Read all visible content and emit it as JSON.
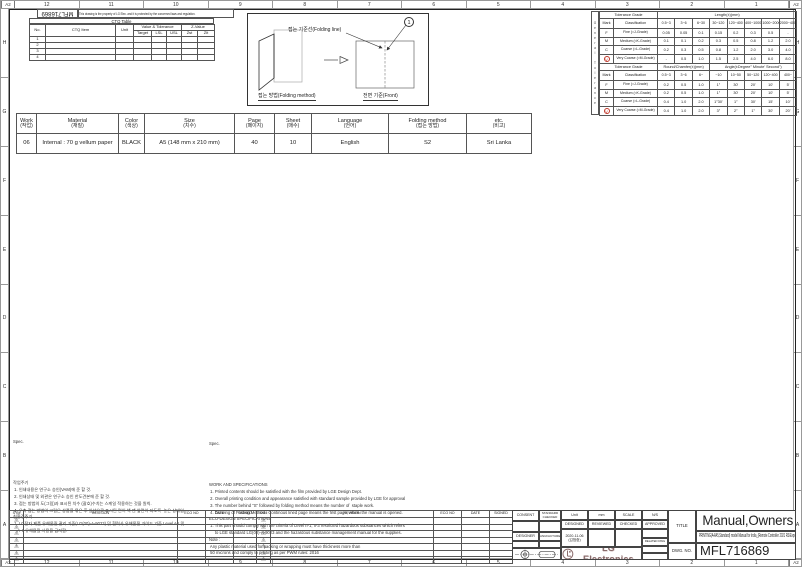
{
  "sheet": {
    "corner": "A2",
    "cols": [
      "12",
      "11",
      "10",
      "9",
      "8",
      "7",
      "6",
      "5",
      "4",
      "3",
      "2",
      "1"
    ],
    "rows": [
      "H",
      "G",
      "F",
      "E",
      "D",
      "C",
      "B",
      "A"
    ]
  },
  "top_left": {
    "doc_no": "MFL716869",
    "disclaimer": "This drawing is the property of LG Elec. and it is protected by the concerned laws and regulation."
  },
  "ctq": {
    "title": "CTQ Table",
    "no": "No.",
    "item": "CTQ Item",
    "unit": "Unit",
    "value_grp": "Value & Tolerance",
    "z_grp": "Z-Value",
    "target": "Target",
    "lsl": "LSL",
    "usl": "USL",
    "zst": "Zst",
    "zlt": "Zlt",
    "rows": [
      "1",
      "2",
      "3",
      "4"
    ]
  },
  "folding": {
    "line_label": "접는 기준선(Folding line)",
    "method_label": "접는 방법(Folding method)",
    "front_label": "전면 기준(Front)",
    "balloon": "1"
  },
  "tolerance": {
    "side_label": "General Tolerance",
    "grade_header": "Tolerance Grade",
    "mark": "Mark",
    "classification": "Classification",
    "length": {
      "span": "Length(±)(mm)",
      "cols": [
        "0.5~3",
        "3~6",
        "6~30",
        "30~120",
        "120~400",
        "400~1000",
        "1000~2000",
        "2000~4000"
      ],
      "rows": [
        [
          "F",
          "Fine (≈J-Grade)",
          "0.05",
          "0.05",
          "0.1",
          "0.15",
          "0.2",
          "0.3",
          "0.5",
          "-"
        ],
        [
          "M",
          "Medium (≈K-Grade)",
          "0.1",
          "0.1",
          "0.2",
          "0.3",
          "0.5",
          "0.8",
          "1.2",
          "2.0"
        ],
        [
          "C",
          "Coarse (≈L-Grade)",
          "0.2",
          "0.3",
          "0.5",
          "0.8",
          "1.2",
          "2.0",
          "3.0",
          "4.0"
        ],
        [
          "V",
          "Very Coarse (≈M-Grade)",
          "-",
          "0.5",
          "1.0",
          "1.5",
          "2.5",
          "4.0",
          "6.0",
          "8.0"
        ]
      ]
    },
    "angle": {
      "round_span": "Round/Chamfer(±)(mm)",
      "angle_span": "Angle(±Degree° Minute' Second\")",
      "cols": [
        "0.5~3",
        "3~6",
        "6~",
        "~10",
        "10~50",
        "50~120",
        "120~400",
        "400~"
      ],
      "rows": [
        [
          "F",
          "Fine (≈J-Grade)",
          "0.2",
          "0.5",
          "1.0",
          "1°",
          "30'",
          "20'",
          "10'",
          "5'"
        ],
        [
          "M",
          "Medium (≈K-Grade)",
          "0.2",
          "0.5",
          "1.0",
          "1°",
          "30'",
          "20'",
          "10'",
          "5'"
        ],
        [
          "C",
          "Coarse (≈L-Grade)",
          "0.4",
          "1.0",
          "2.0",
          "1°30'",
          "1°",
          "30'",
          "15'",
          "10'"
        ],
        [
          "V",
          "Very Coarse (≈M-Grade)",
          "0.4",
          "1.0",
          "2.0",
          "3°",
          "2°",
          "1°",
          "30'",
          "20'"
        ]
      ]
    }
  },
  "spec": {
    "headers": [
      {
        "en": "Work",
        "ko": "(작업)"
      },
      {
        "en": "Material",
        "ko": "(재질)"
      },
      {
        "en": "Color",
        "ko": "(색상)"
      },
      {
        "en": "Size",
        "ko": "(치수)"
      },
      {
        "en": "Page",
        "ko": "(페이지)"
      },
      {
        "en": "Sheet",
        "ko": "(매수)"
      },
      {
        "en": "Language",
        "ko": "(언어)"
      },
      {
        "en": "Folding method",
        "ko": "(접는 방법)"
      },
      {
        "en": "etc.",
        "ko": "(비고)"
      }
    ],
    "values": [
      "06",
      "Internal : 70 g vellum paper",
      "BLACK",
      "A5 (148 mm x 210 mm)",
      "40",
      "10",
      "English",
      "S2",
      "Sri Lanka"
    ]
  },
  "notes_ko": {
    "heading": "Spec.",
    "lines": [
      "작업주기",
      " 1. 인쇄내용은 연구소 승인(VAM)에 준 할 것.",
      " 2. 인쇄상태 및 외관은 연구소 승인 한도견본에 준 할 것.",
      " 3. 접는 방법의 도(그림)과 표시된 치수 (괄호)수치는 스케일 적용하는 것을 원칙.",
      " 4. 우측 접는 방법의 그림은 상품을 묶은 후 실선으로 표시된 면이 책 맨 앞면이 되도록  놓은 상태임.",
      "친환경주기",
      " 1. LG전자 제품 유해물질 관리 기준(LG(00)-A-9023) 및 협력사 유해물질 가이드 기준 Level A-I 및",
      "    A-II 유해물질 사용을 금지함."
    ]
  },
  "notes_en": {
    "heading": "Spec.",
    "lines": [
      "WORK AND SPECIFICATIONS",
      " 1. Printed contents should be satisfied with the film provided by LGE Design Dept.",
      " 2. Overall printing condition and appearance satisfied with standard sample provided by LGE for approval",
      " 3. The number behind \"S\" followed by folding method means the number of  staple work.",
      " 4. Drawing of Folding Method : Continous lined page means the first page, when  the manual is opened.",
      "ECO-DESIGN SPECIFICATIONS",
      " 1. This part should comply with the criteria of Level II-1, II-3 restricted hazardous substances which refers",
      "     to LGE standard LG(00)-A-9023 and the hazardous substance management manual for the supplies.",
      "",
      "Note :",
      " Any plastic material used for packing or wrapping must have thickness more than",
      " 50 microns and comply to printing as per PWM rules: 2016"
    ]
  },
  "revision": {
    "headers": [
      "SYM",
      "REVISION",
      "ECO NO",
      "DATE",
      "SIGNED"
    ],
    "rows": [
      "1",
      "2",
      "3",
      "4",
      "5",
      "6",
      "7"
    ]
  },
  "title_block": {
    "consent": "CONSENT",
    "standard_checked": "STANDARD CHECKED",
    "designer": "DESIGNER",
    "manufacturer": "MANUFACTURER",
    "unit_label": "Unit",
    "unit_value": "mm",
    "scale_label": "SCALE",
    "scale_value": "N/S",
    "designed": "DESIGNED",
    "reviewed": "REVIEWED",
    "checked": "CHECKED",
    "approved": "APPROVED",
    "designed_date": "2020-11-06",
    "designed_by": "(김범중)",
    "related_dwg": "RELATED DWG",
    "company": "LG Electronics",
    "title_label": "TITLE",
    "title": "Manual,Owners",
    "subtitle": "PRINTING(A4/A5,Standard) model Manual for India_(Remote Controller 2021 RS/Export)",
    "dwg_label": "DWG. NO.",
    "dwg_no": "MFL716869"
  },
  "colors": {
    "accent_red": "#c0392b",
    "logo": "#8a6b6b",
    "line": "#222222"
  }
}
